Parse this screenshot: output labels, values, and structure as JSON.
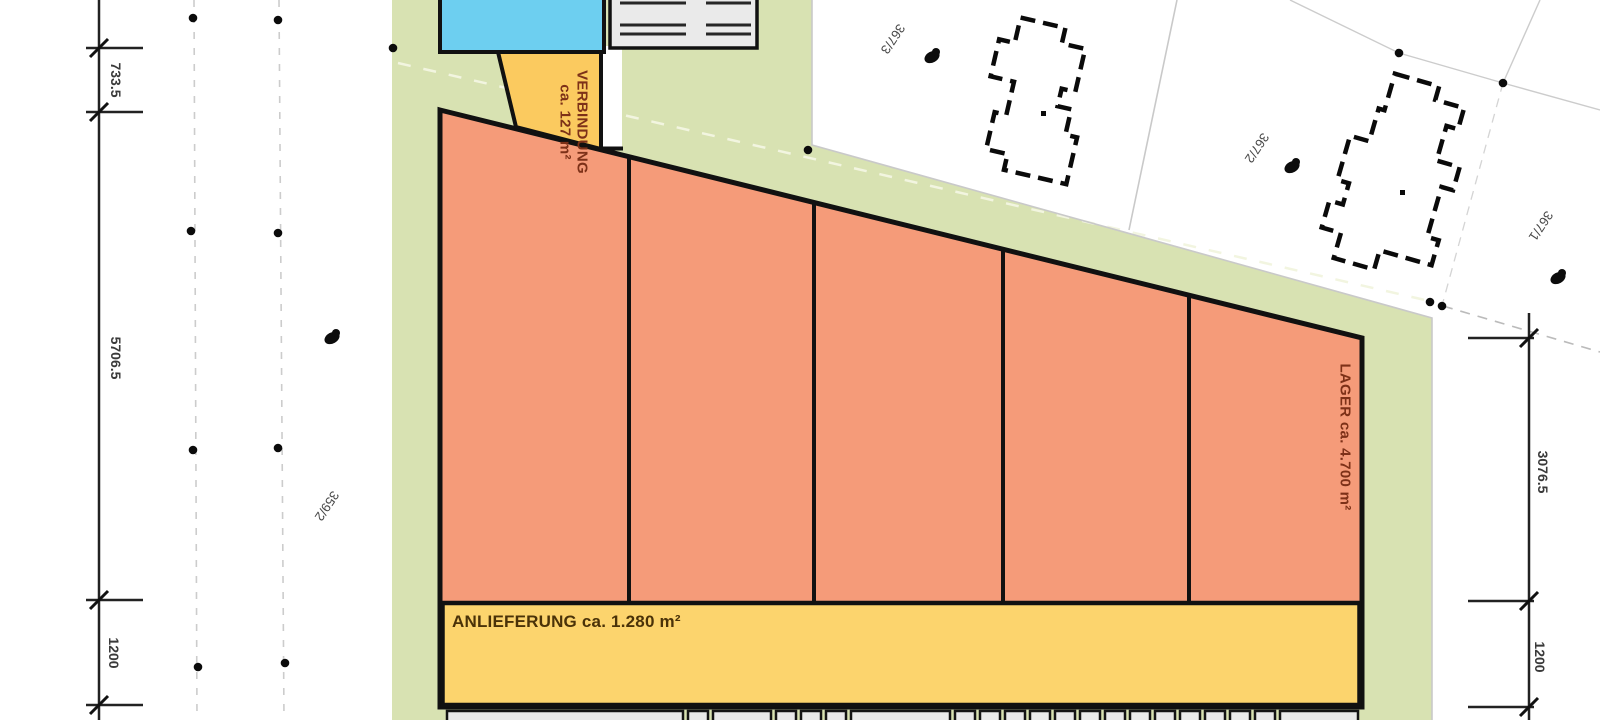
{
  "colors": {
    "site-green": "#d8e2b2",
    "hall-orange": "#f59b79",
    "strip-yellow": "#fcd46d",
    "corridor-yellow": "#fbca5f",
    "pool-blue": "#6dcff0",
    "dock-gray": "#e9e9e9",
    "room-text": "#7d3118",
    "delivery-text": "#4a3208",
    "dim-text": "#3a3a3a",
    "parcel-text": "#474747"
  },
  "rooms": {
    "verbindung": {
      "name": "VERBINDUNG",
      "area": "ca. 127 m²"
    },
    "lager": {
      "label": "LAGER ca. 4.700 m²"
    },
    "anlieferung": {
      "label": "ANLIEFERUNG ca. 1.280 m²"
    }
  },
  "dimensions": {
    "left_top": "733.5",
    "left_middle": "5706.5",
    "left_bottom": "1200",
    "right_top": "3076.5",
    "right_bottom": "1200"
  },
  "parcels": {
    "p367_3": "367/3",
    "p367_2": "367/2",
    "p367_1": "367/1",
    "p359_2": "359/2"
  }
}
